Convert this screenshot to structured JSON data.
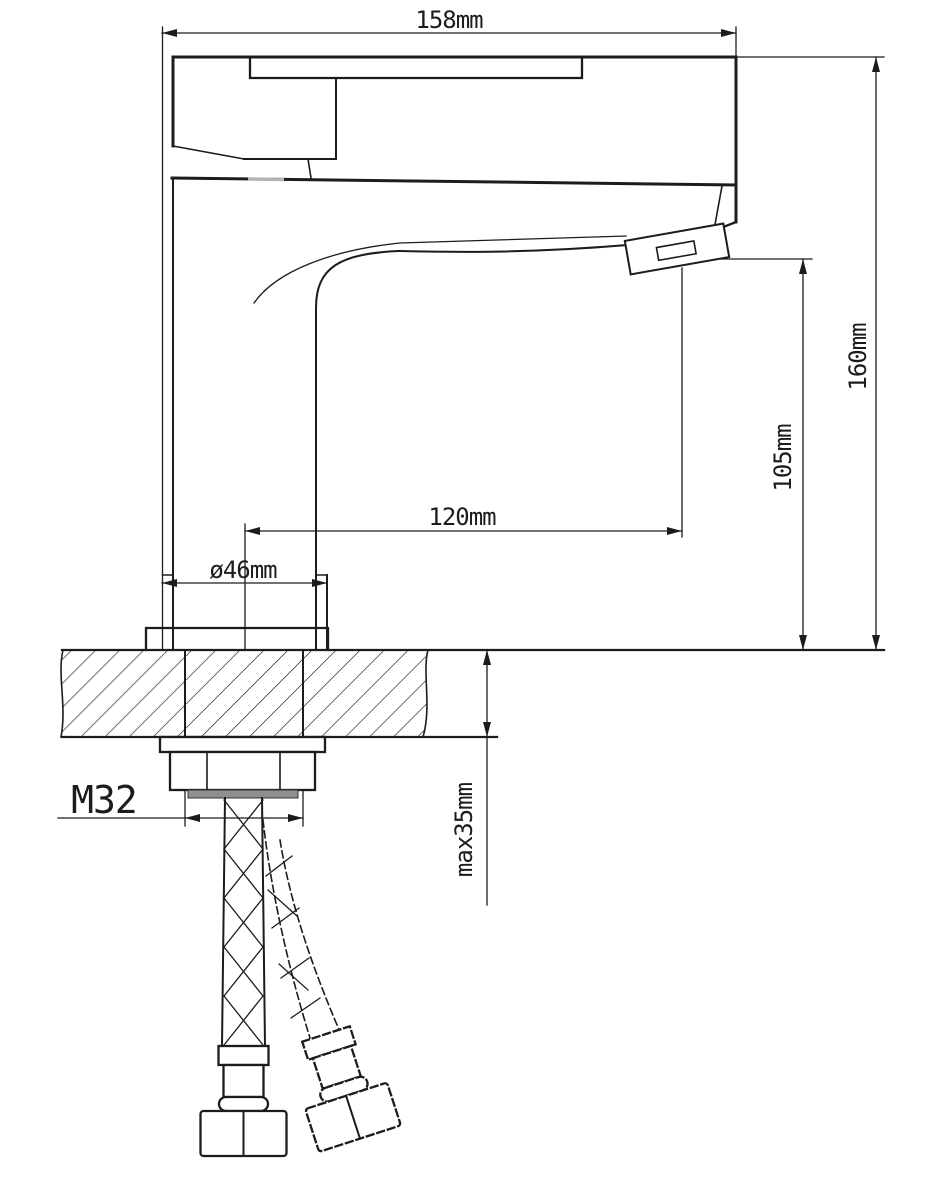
{
  "drawing": {
    "type": "faucet-installation-technical-drawing",
    "dimensions": {
      "spout_width_top": "158mm",
      "total_height": "160mm",
      "spout_outlet_height": "105mm",
      "spout_reach": "120mm",
      "base_diameter": "ø46mm",
      "mounting_thread": "M32",
      "max_countertop_thickness": "max35mm"
    },
    "colors": {
      "line": "#1c1c1c",
      "background": "#ffffff",
      "seal": "#8f8f8f",
      "accent_grey": "#b3b3b3"
    }
  }
}
